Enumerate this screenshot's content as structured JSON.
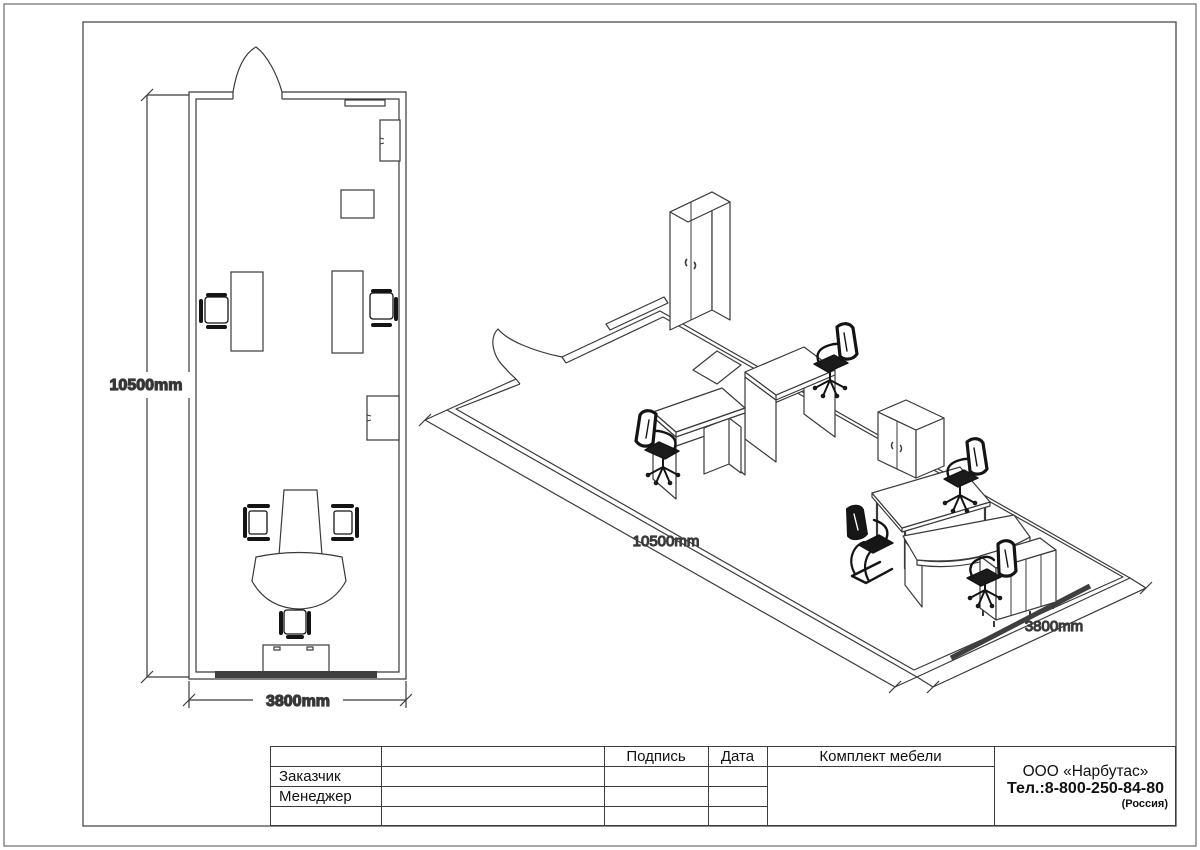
{
  "drawing": {
    "plan": {
      "height_label": "10500mm",
      "width_label": "3800mm"
    },
    "iso": {
      "length_label": "10500mm",
      "width_label": "3800mm"
    }
  },
  "title_block": {
    "headers": {
      "signature": "Подпись",
      "date": "Дата",
      "furniture_set": "Комплект мебели"
    },
    "row_labels": {
      "customer": "Заказчик",
      "manager": "Менеджер"
    },
    "company": {
      "name": "ООО «Нарбутас»",
      "phone": "Тел.:8-800-250-84-80",
      "country": "(Россия)"
    }
  }
}
